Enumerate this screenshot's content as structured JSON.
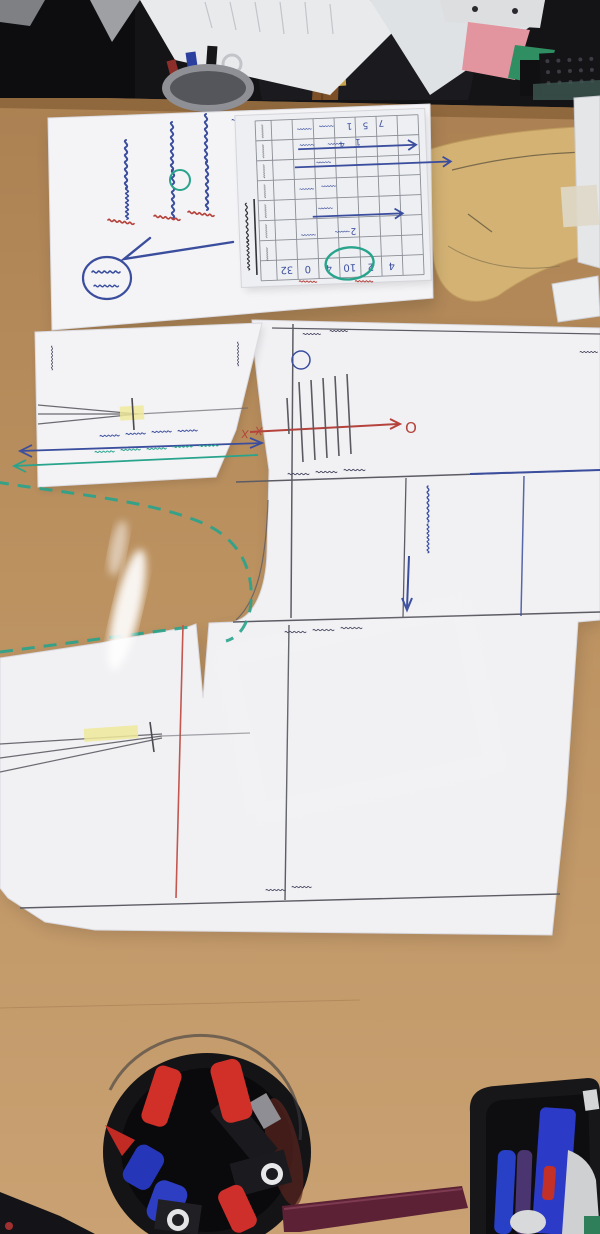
{
  "scene": {
    "type": "photograph",
    "summary": "Overhead photo of a garment pattern-drafting worktable: white drafting sheets with pencil, red, blue and teal guide lines, a memo sheet with upside-down Korean handwriting, a printed schedule form, marker cups and a bag at the far edge"
  },
  "colors": {
    "table": "#b9905f",
    "table_light": "#c9a172",
    "paper": "#f2f2f5",
    "ink_blue": "#3b4e9e",
    "ink_red": "#b5433c",
    "ink_teal": "#28a38c",
    "pencil": "#5c5c64",
    "highlighter": "#efe99a",
    "kraft_piece": "#d4b274",
    "bag": "#1b1b1f",
    "strap": "#8a5a2e",
    "buckle": "#c9a24a",
    "marker_red": "#d03028",
    "marker_blue": "#2b3bc8",
    "ruler": "#5c2135"
  },
  "memo": {
    "handwriting_is_upside_down": true,
    "columns": [
      {
        "blue": "원형 응용 변형",
        "red": "완성"
      },
      {
        "blue": "뒤판 제도 하기",
        "red": "확인"
      },
      {
        "blue": "옆선 정리",
        "red": "보충"
      }
    ],
    "circled_word": "믿음",
    "corner_scribble": "(주) 표시",
    "flourish": "긴 체크 표시"
  },
  "form": {
    "title": "시간표 (인쇄 서식, 거꾸로 놓임)",
    "digits": [
      "1",
      "5",
      "7",
      "1",
      "4",
      "2"
    ],
    "bottom_row_values": [
      "32",
      "0",
      "4",
      "10",
      "2",
      "4"
    ],
    "annotations": {
      "teal_oval": "한 열에 청록색 타원 표시",
      "red_marks": "붉은 밑줄 2곳",
      "blue_arrows": "파란 화살표 3개"
    }
  },
  "draft": {
    "labels": {
      "waist": "허리선",
      "hip": "엉덩이선",
      "crotch": "밑위선",
      "hem": "밑단",
      "panel": "뒤판 골선",
      "side_small": "옆선",
      "blue_note": "밑위 앞뒤 길이",
      "teal_note": "고무밴드 허리둘레 길이",
      "edge_partial": "뒤"
    },
    "marks": {
      "o": "O",
      "x": "X"
    }
  },
  "items": {
    "top_shelf": [
      "검정 가방",
      "갈색 가죽끈과 금색 버클",
      "흰 서류 뭉치",
      "펜꽂이",
      "분홍 파일",
      "초록 파일",
      "검정 키보드"
    ],
    "bottom_desk": [
      "둥근 검정 펜통(빨강·파랑·검정 마커)",
      "검정 펜 트레이(파랑·보라 펜)",
      "자주색 자"
    ]
  }
}
